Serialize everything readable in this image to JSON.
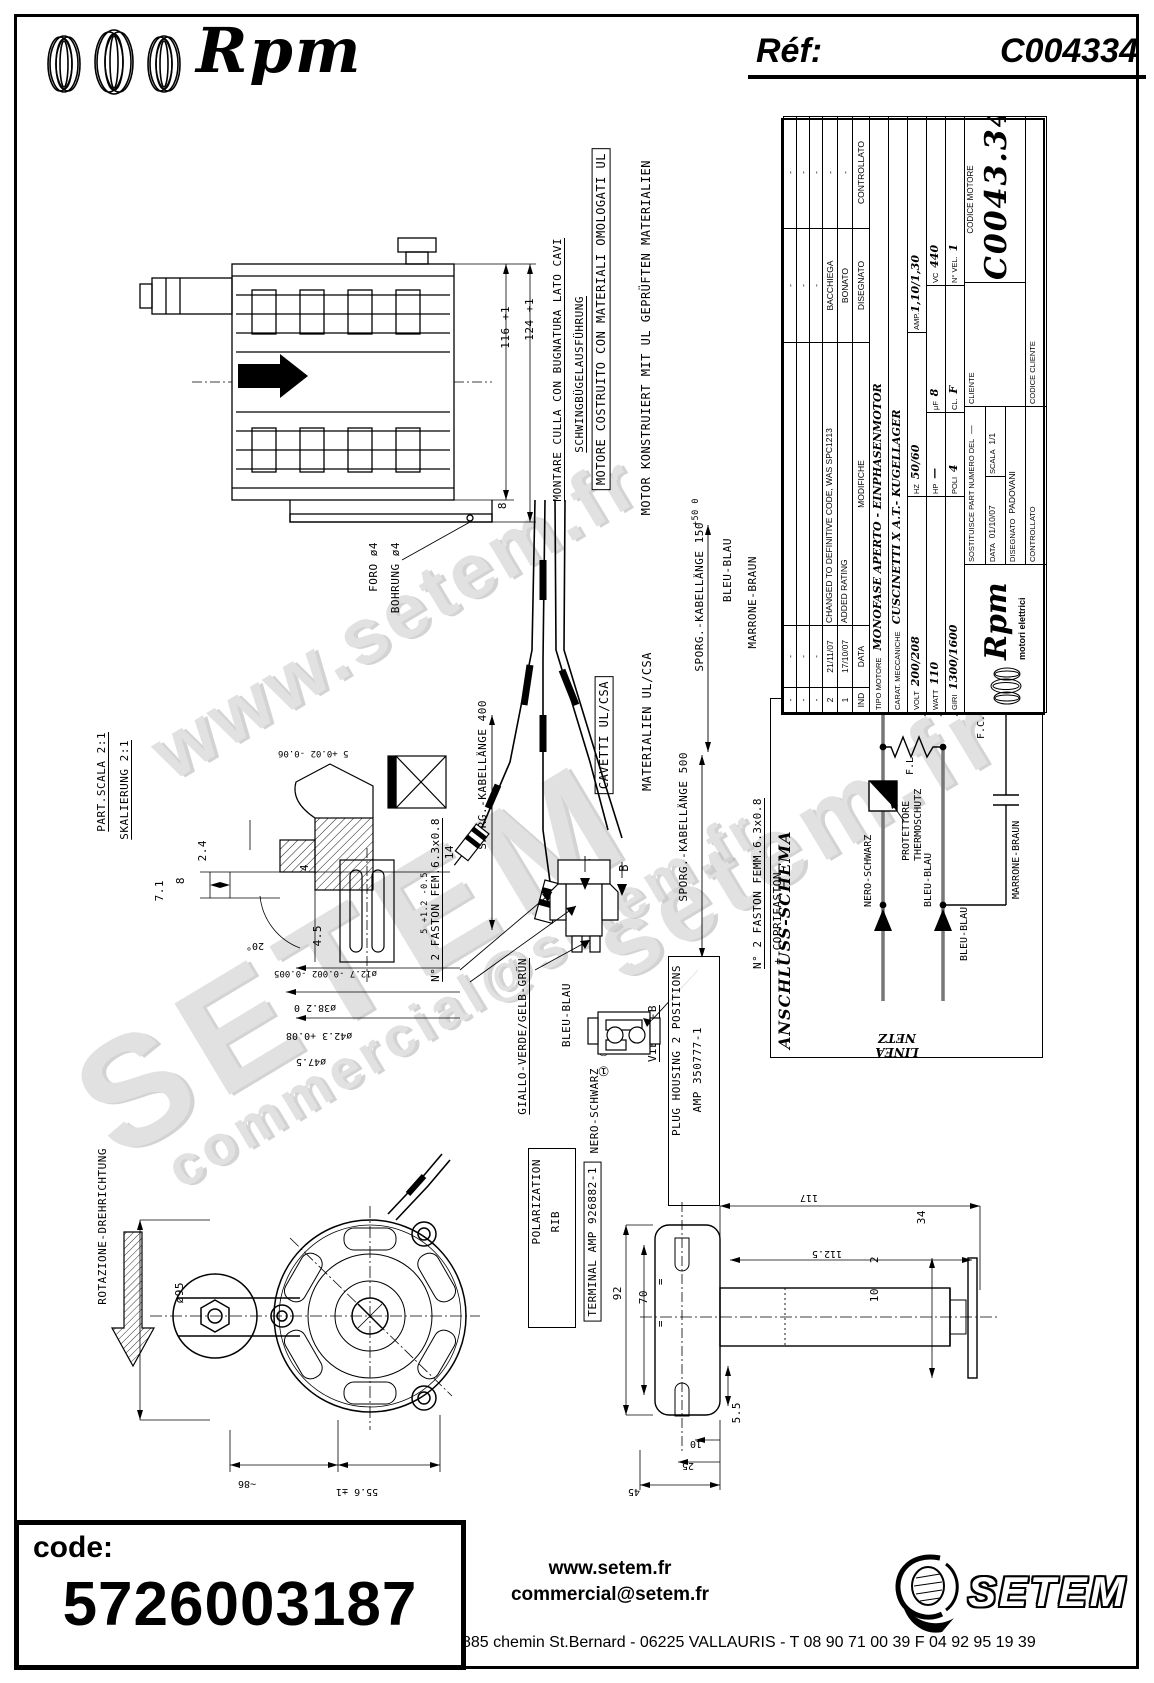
{
  "header": {
    "brand": "Rpm",
    "ref_label": "Réf:",
    "ref_value": "C004334"
  },
  "watermarks": {
    "wm1": "www.setem.fr",
    "wm2": "SETEM",
    "wm3": "commercial@setem.fr",
    "wm4": "setem.fr"
  },
  "labels": {
    "montare": "MONTARE CULLA CON BUGNATURA LATO CAVI",
    "schwing": "SCHWINGBÜGELAUSFÜHRUNG",
    "ul_it": "MOTORE COSTRUITO CON MATERIALI OMOLOGATI UL",
    "ul_de": "MOTOR KONSTRUIERT MIT UL GEPRÜFTEN MATERIALIEN",
    "foro": "FORO ø4",
    "bohrung": "BOHRUNG ø4",
    "part_scala": "PART.SCALA 2:1",
    "skalierung": "SKALIERUNG 2:1",
    "kab400": "SPORG.-KABELLÄNGE 400",
    "kab500": "SPORG.-KABELLÄNGE 500",
    "kab150": "SPORG.-KABELLÄNGE 150",
    "kab150_tol": "+50 0",
    "cavetti": "CAVETTI UL/CSA",
    "materialien": "MATERIALIEN UL/CSA",
    "faston_fem": "N° 2 FASTON FEM.6.3x0.8",
    "giallo": "GIALLO-VERDE/GELB-GRÜN",
    "bleu": "BLEU-BLAU",
    "marrone": "MARRONE-BRAUN",
    "nero": "NERO-SCHWARZ",
    "view_bb": "VIEW B-B",
    "plug_housing1": "PLUG HOUSING 2 POSITIONS",
    "plug_housing2": "AMP 350777-1",
    "polarization": "POLARIZATION",
    "rib": "RIB",
    "terminal": "TERMINAL AMP 926882-1",
    "faston_femm": "N° 2 FASTON FEMM.6.3x0.8",
    "coprifaston": "+ COPRIFASTON",
    "rotazione": "ROTAZIONE-DREHRICHTUNG",
    "b": "B",
    "circ12": "① ②"
  },
  "schema": {
    "title": "ANSCHLUSS-SCHEMA",
    "linea": "LINEA",
    "netz": "NETZ",
    "nero": "NERO-SCHWARZ",
    "bleu": "BLEU-BLAU",
    "marrone": "MARRONE-BRAUN",
    "prot1": "PROTETTORE",
    "prot2": "THERMOSCHUTZ",
    "fl": "F.L.",
    "fc": "F.C."
  },
  "dims": {
    "d116": "116 +1",
    "d124": "124 +1",
    "d8": "8",
    "d7_1": "7.1",
    "d2_4": "2.4",
    "d4": "4",
    "d4_5": "4.5",
    "d20": "20°",
    "d5t": "5 +0.02 -0.06",
    "d14": "14",
    "d5b": "5 +1.2 -0.5",
    "d12_7": "ø12.7 -0.002 -0.005",
    "d38_2": "ø38.2 0",
    "d42_3": "ø42.3 +0.08",
    "d47_5": "ø47.5",
    "d95": "ø95",
    "d86": "~86",
    "d55_6": "55.6 ±1",
    "d117": "117",
    "d112_5": "112.5",
    "d92": "92",
    "d70": "70",
    "eq": "=",
    "d5_5": "5.5",
    "d10": "10",
    "d2": "2",
    "d34": "34",
    "d25": "25",
    "d45": "45"
  },
  "title_block": {
    "revisions": {
      "h_ind": "IND",
      "h_data": "DATA",
      "h_mod": "MODIFICHE",
      "h_dis": "DISEGNATO",
      "h_ctrl": "CONTROLLATO",
      "rows": [
        {
          "ind": "-",
          "data": "-",
          "mod": "",
          "dis": "-",
          "ctrl": "-"
        },
        {
          "ind": "-",
          "data": "-",
          "mod": "",
          "dis": "-",
          "ctrl": "-"
        },
        {
          "ind": "-",
          "data": "-",
          "mod": "",
          "dis": "-",
          "ctrl": "-"
        },
        {
          "ind": "2",
          "data": "21/11/07",
          "mod": "CHANGED TO DEFINITIVE CODE, WAS SPC1213",
          "dis": "BACCHIEGA",
          "ctrl": "-"
        },
        {
          "ind": "1",
          "data": "17/10/07",
          "mod": "ADDED RATING",
          "dis": "BONATO",
          "ctrl": "-"
        }
      ]
    },
    "tipo_label": "TIPO MOTORE",
    "tipo_value": "MONOFASE APERTO - EINPHASENMOTOR",
    "carat_label": "CARAT. MECCANICHE",
    "carat_value": "CUSCINETTI X A.T.- KUGELLAGER",
    "volt_label": "VOLT",
    "volt": "200/208",
    "hz_label": "HZ",
    "hz": "50/60",
    "amp_label": "AMP.",
    "amp": "1,10/1,30",
    "watt_label": "WATT",
    "watt": "110",
    "hp_label": "HP",
    "hp": "—",
    "uf_label": "μF",
    "uf": "8",
    "vc_label": "VC",
    "vc": "440",
    "giri_label": "GIRI",
    "giri": "1300/1600",
    "poli_label": "POLI",
    "poli": "4",
    "cl_label": "CL.",
    "cl": "F",
    "nvel_label": "N° VEL.",
    "nvel": "1",
    "cliente_label": "CLIENTE",
    "codice_motore_label": "CODICE MOTORE",
    "codice_motore": "C0043.34",
    "codice_cliente_label": "CODICE CLIENTE",
    "logo_text": "Rpm",
    "logo_sub": "motori elettrici",
    "sostituisce": "SOSTITUISCE PART NUMERO DEL",
    "sostituisce_val": "—",
    "data_label": "DATA",
    "data_val": "01/10/07",
    "scala_label": "SCALA",
    "scala_val": "1/1",
    "disegnato_label": "DISEGNATO",
    "disegnato_val": "PADOVANI",
    "controllato_label": "CONTROLLATO"
  },
  "footer": {
    "code_label": "code:",
    "code_value": "5726003187",
    "site": "www.setem.fr",
    "email": "commercial@setem.fr",
    "address": "885 chemin St.Bernard  -  06225 VALLAURIS  -  T 08 90 71 00 39   F 04 92 95 19 39",
    "brand": "SETEM"
  }
}
